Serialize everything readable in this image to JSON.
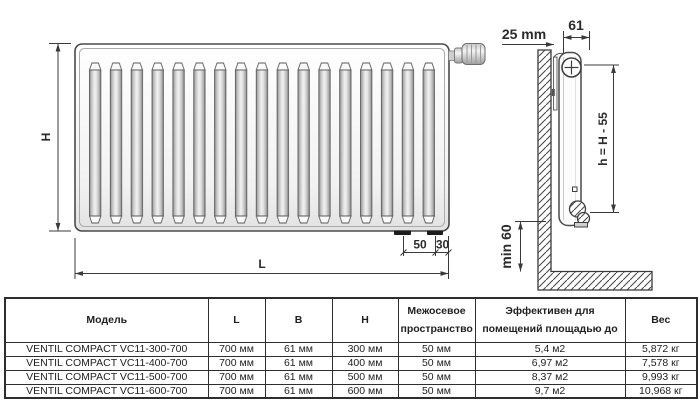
{
  "diagram": {
    "front_view": {
      "height_label": "H",
      "length_label": "L",
      "offset_50_label": "50",
      "offset_30_label": "30"
    },
    "side_view": {
      "wall_gap_label": "25 mm",
      "depth_label": "61",
      "axis_height_label": "h = H - 55",
      "floor_clearance_label": "min 60"
    },
    "colors": {
      "line": "#3a3a3a",
      "panel_light": "#ffffff",
      "panel_dark": "#e4e4e4"
    }
  },
  "table": {
    "headers": [
      "Модель",
      "L",
      "B",
      "H",
      "Межосевое пространство",
      "Эффективен для помещений площадью до",
      "Вес"
    ],
    "rows": [
      [
        "VENTIL COMPACT VC11-300-700",
        "700 мм",
        "61 мм",
        "300 мм",
        "50 мм",
        "5,4 м2",
        "5,872 кг"
      ],
      [
        "VENTIL COMPACT VC11-400-700",
        "700 мм",
        "61 мм",
        "400 мм",
        "50 мм",
        "6,97 м2",
        "7,578 кг"
      ],
      [
        "VENTIL COMPACT VC11-500-700",
        "700 мм",
        "61 мм",
        "500 мм",
        "50 мм",
        "8,37 м2",
        "9,993 кг"
      ],
      [
        "VENTIL COMPACT VC11-600-700",
        "700 мм",
        "61 мм",
        "600 мм",
        "50 мм",
        "9,7 м2",
        "10,968 кг"
      ]
    ]
  }
}
